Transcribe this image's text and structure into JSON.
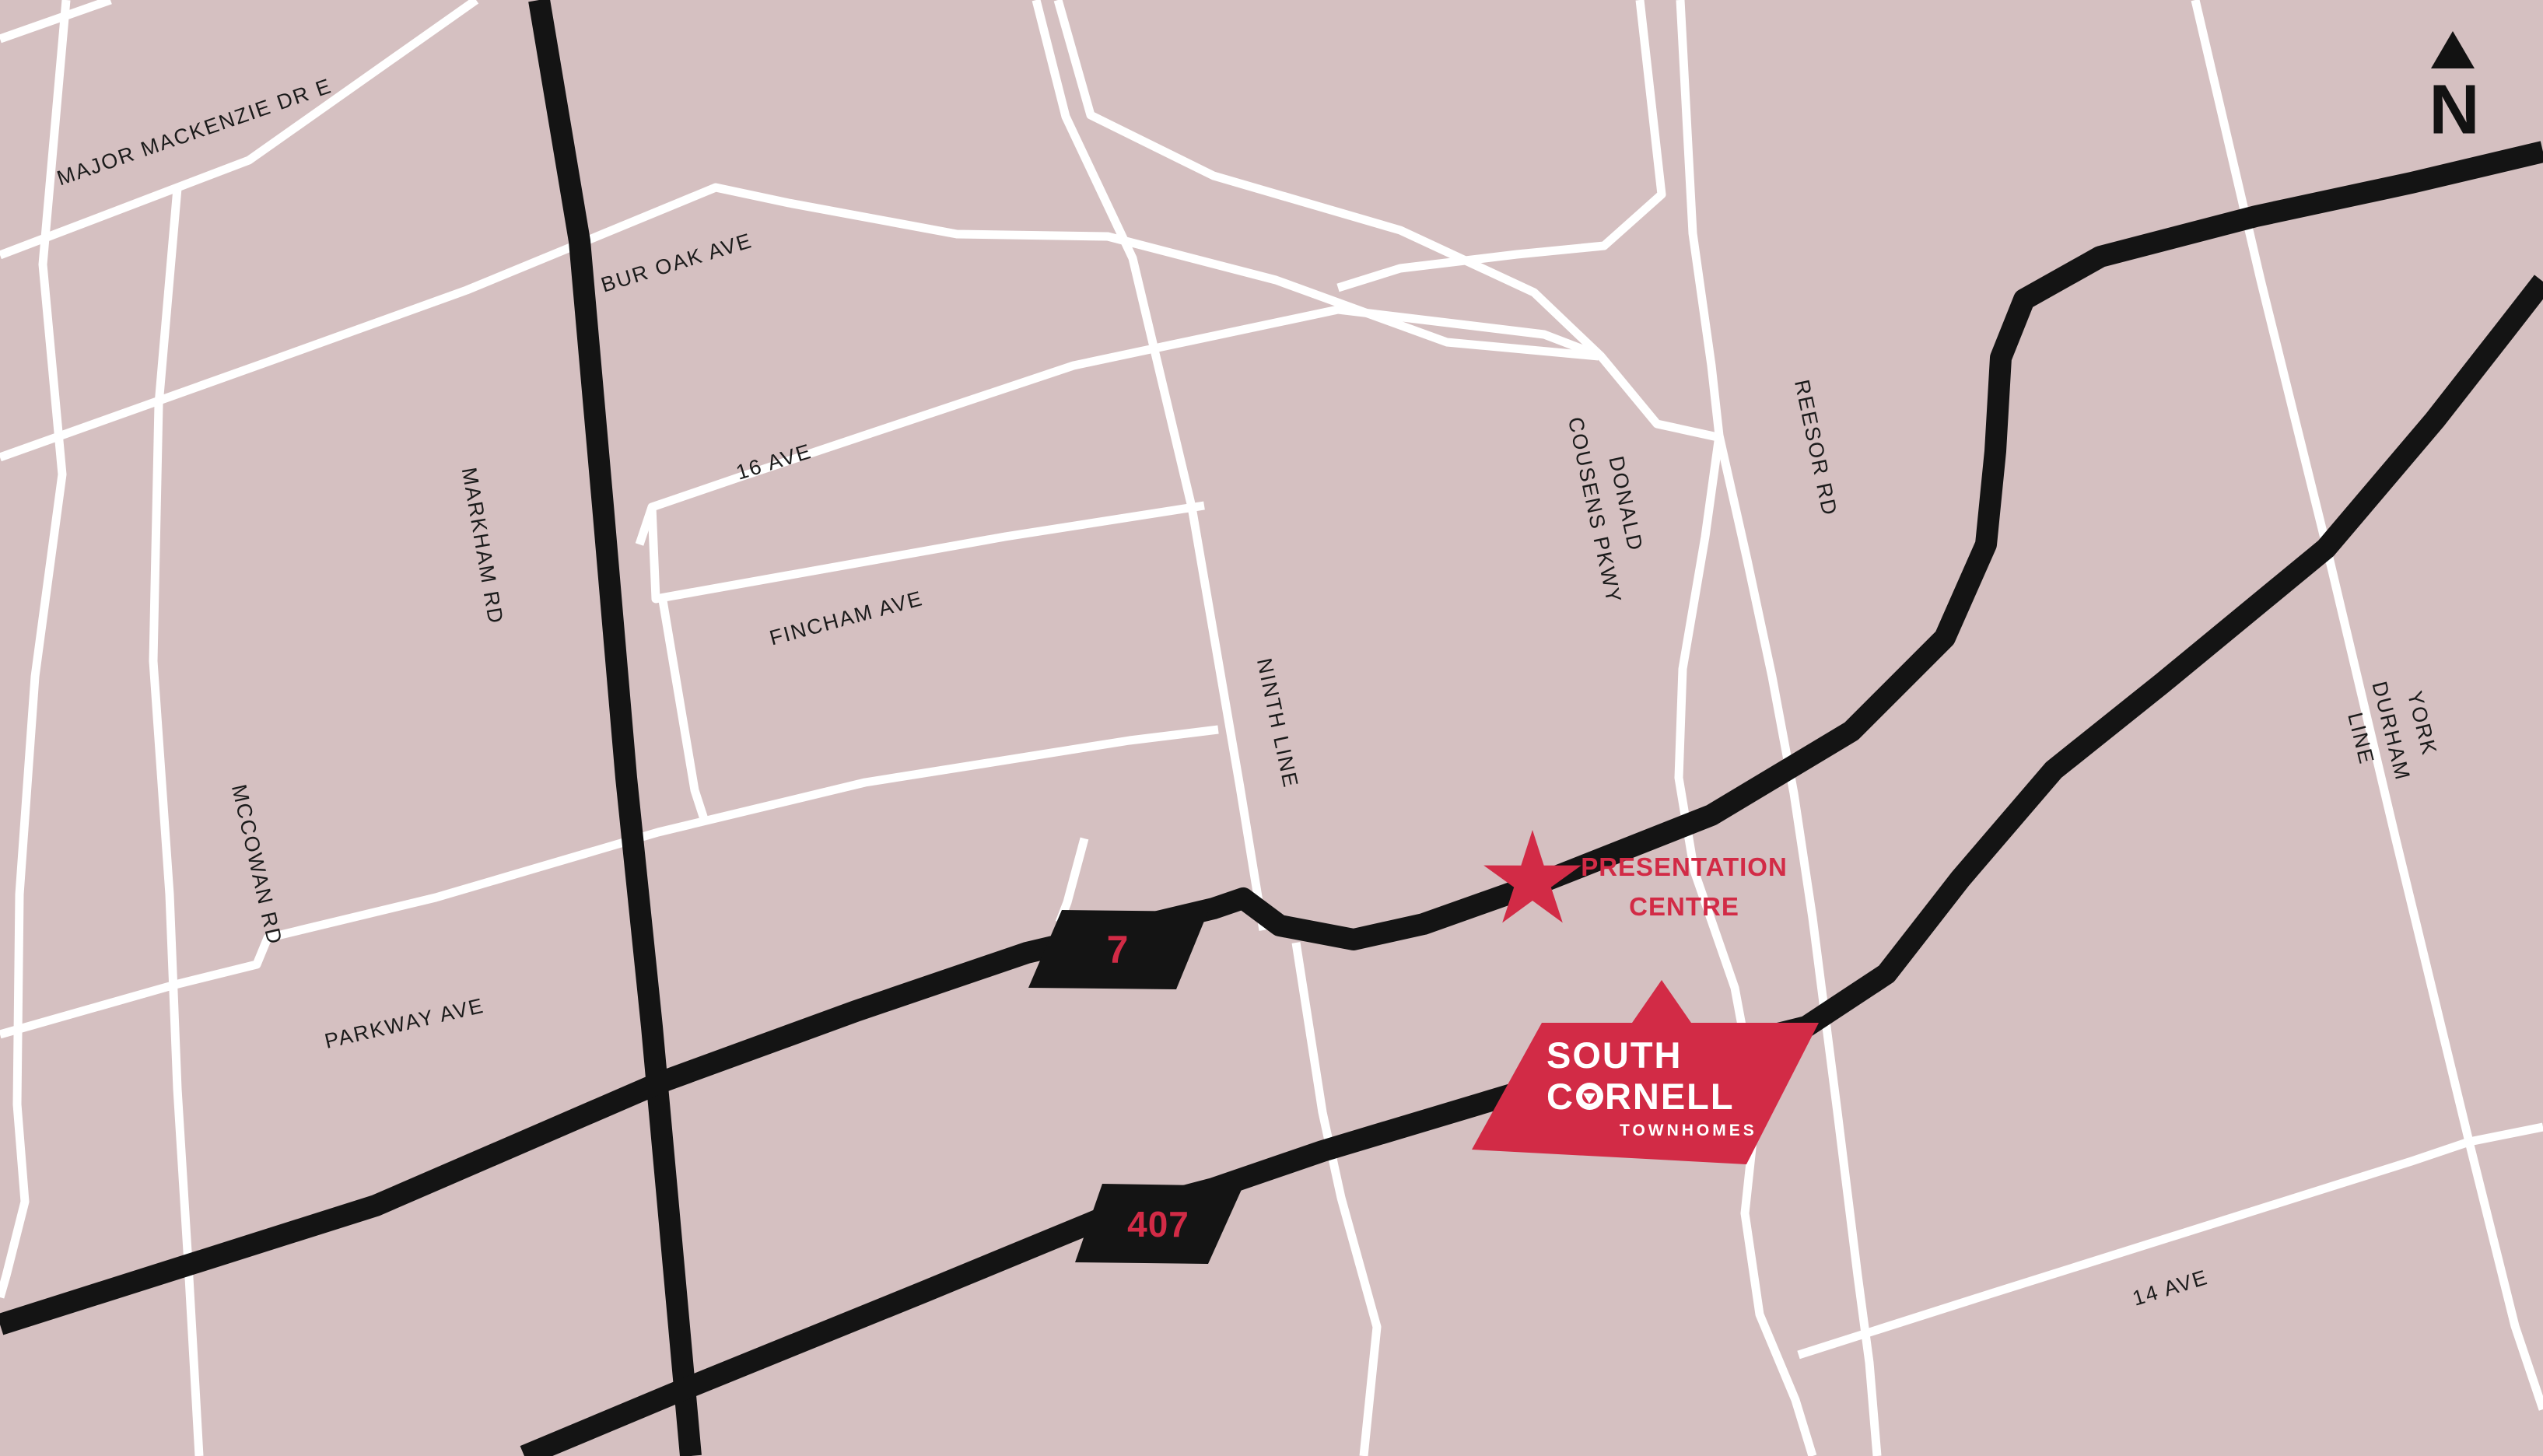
{
  "map": {
    "colors": {
      "background": "#d5c0c1",
      "minor_road": "#ffffff",
      "major_road": "#141414",
      "accent": "#d22b46",
      "label": "#1b1b1b"
    },
    "north": {
      "label": "N"
    },
    "marker": {
      "label": "PRESENTATION\nCENTRE"
    },
    "shields": [
      {
        "number": "7"
      },
      {
        "number": "407"
      }
    ],
    "road_labels": [
      {
        "id": "major-mackenzie-dr-e",
        "text": "MAJOR MACKENZIE DR E"
      },
      {
        "id": "bur-oak-ave",
        "text": "BUR OAK AVE"
      },
      {
        "id": "16-ave",
        "text": "16 AVE"
      },
      {
        "id": "fincham-ave",
        "text": "FINCHAM AVE"
      },
      {
        "id": "markham-rd",
        "text": "MARKHAM RD"
      },
      {
        "id": "mccowan-rd",
        "text": "MCCOWAN RD"
      },
      {
        "id": "parkway-ave",
        "text": "PARKWAY AVE"
      },
      {
        "id": "ninth-line",
        "text": "NINTH LINE"
      },
      {
        "id": "donald-cousens-pkwy",
        "text": "DONALD\nCOUSENS PKWY"
      },
      {
        "id": "reesor-rd",
        "text": "REESOR RD"
      },
      {
        "id": "york-durham-line",
        "text": "YORK DURHAM LINE"
      },
      {
        "id": "14-ave",
        "text": "14 AVE"
      }
    ],
    "logo": {
      "line1": "SOUTH",
      "line2_prefix": "C",
      "line2_suffix": "RNELL",
      "line3": "TOWNHOMES"
    }
  }
}
